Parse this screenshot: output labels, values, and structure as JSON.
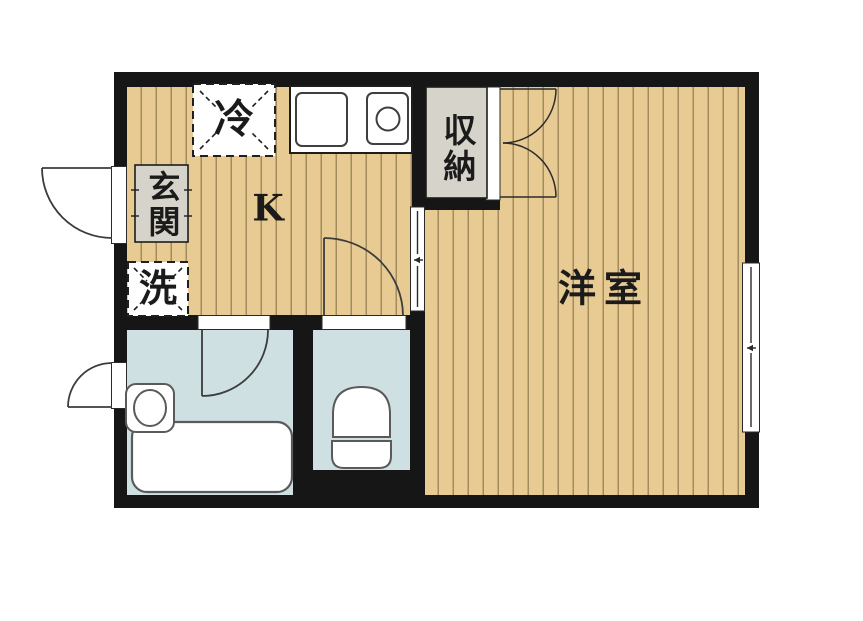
{
  "rooms": {
    "kitchen": {
      "label": "K"
    },
    "western_room": {
      "label": "洋室"
    },
    "entrance": {
      "label": "玄関"
    },
    "closet": {
      "label": "収納"
    },
    "washing_machine": {
      "label": "洗"
    },
    "refrigerator": {
      "label": "冷"
    }
  },
  "colors": {
    "wall": "#161616",
    "wood-floor": "#e8cb93",
    "wet-area": "#cfe0e2",
    "gray-area": "#d6d3cb",
    "line": "#3c3c3c",
    "bg": "#ffffff"
  }
}
